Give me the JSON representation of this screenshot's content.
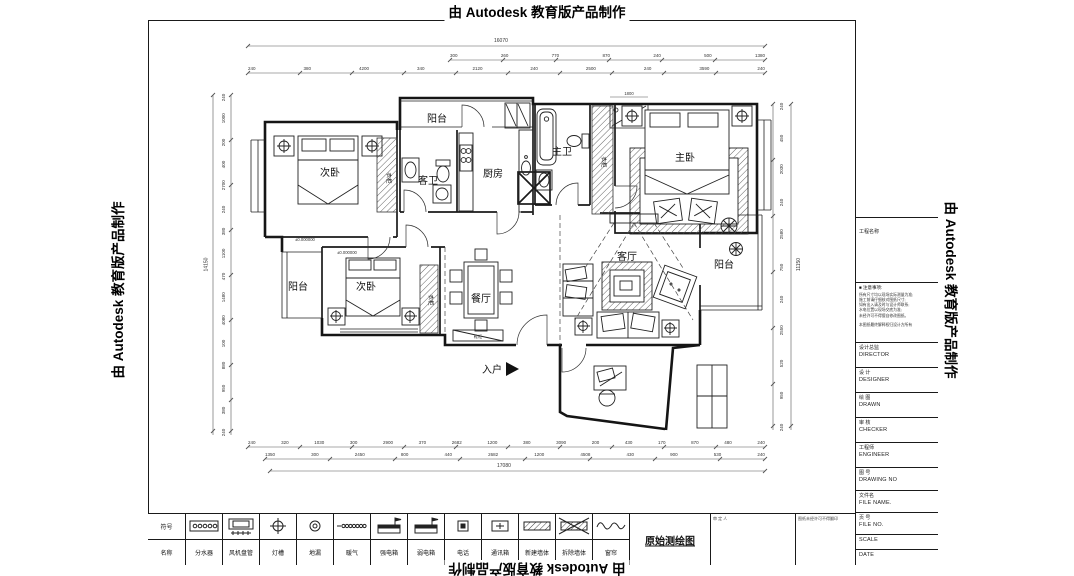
{
  "stamps": {
    "text": "由 Autodesk 教育版产品制作"
  },
  "plan": {
    "rooms": {
      "balcony_top": "阳台",
      "bedroom_top": "次卧",
      "guest_bath": "客卫",
      "kitchen": "厨房",
      "master_bath": "主卫",
      "master_bedroom": "主卧",
      "living": "客厅",
      "balcony_right": "阳台",
      "dining": "餐厅",
      "bedroom_bottom": "次卧",
      "balcony_left": "阳台",
      "entry": "入户",
      "wardrobe": "衣柜",
      "shoe_cabinet": "鞋柜"
    },
    "annotations": {
      "shower_width": "1800",
      "elevation1": "±0.000000",
      "elevation2": "±0.000000"
    }
  },
  "dims": {
    "top_overall": "16070",
    "top_row2": [
      "300",
      "260",
      "770",
      "870",
      "240",
      "500",
      "1380"
    ],
    "top_row3": [
      "240",
      "380",
      "4200",
      "340",
      "2120",
      "240",
      "2500",
      "240",
      "3590",
      "240"
    ],
    "bottom_row1": [
      "240",
      "320",
      "1030",
      "300",
      "2900",
      "370",
      "2682",
      "1200",
      "380",
      "3090",
      "200",
      "430",
      "170",
      "870",
      "480",
      "240"
    ],
    "bottom_row2": [
      "1350",
      "300",
      "2450",
      "800",
      "440",
      "2682",
      "1200",
      "4508",
      "430",
      "900",
      "530",
      "240"
    ],
    "bottom_overall": "17080",
    "left_col": [
      "240",
      "1000",
      "200",
      "400",
      "2700",
      "240",
      "380",
      "1100",
      "470",
      "1480",
      "4080",
      "100",
      "880",
      "950",
      "380",
      "240"
    ],
    "left_overall": "14150",
    "right_col": [
      "240",
      "450",
      "2030",
      "240",
      "2580",
      "750",
      "240",
      "2550",
      "520",
      "950",
      "240"
    ],
    "right_overall": "11150"
  },
  "legend": {
    "header_top": "符号",
    "header_bottom": "名称",
    "items": [
      {
        "name": "分水器",
        "icon": "manifold-icon"
      },
      {
        "name": "风机盘管",
        "icon": "fan-coil-icon"
      },
      {
        "name": "灯槽",
        "icon": "lamp-trough-icon"
      },
      {
        "name": "地漏",
        "icon": "floor-drain-icon"
      },
      {
        "name": "暖气",
        "icon": "radiator-icon"
      },
      {
        "name": "强电箱",
        "icon": "power-box-icon"
      },
      {
        "name": "弱电箱",
        "icon": "weak-current-box-icon"
      },
      {
        "name": "电话",
        "icon": "phone-icon"
      },
      {
        "name": "通讯箱",
        "icon": "comm-box-icon"
      },
      {
        "name": "新建墙体",
        "icon": "new-wall-icon"
      },
      {
        "name": "拆除墙体",
        "icon": "demolish-wall-icon"
      },
      {
        "name": "窗帘",
        "icon": "curtain-icon"
      }
    ]
  },
  "footer": {
    "title": "原始测绘图",
    "approver_label": "审 定 人",
    "note": "图纸未经许可不得翻印"
  },
  "titleblock": {
    "project_label": "工程名称",
    "notes_header": "■ 注意事项:",
    "notes": [
      "所有尺寸均以现场实际测量为准;",
      "施工前请仔细核对图纸尺寸;",
      "如有出入请及时与设计师联系;",
      "水电位置以现场交底为准;",
      "未经许可不得擅自修改图纸。"
    ],
    "notes_footer": "本图纸最终解释权归设计方所有",
    "rows": [
      {
        "cn": "设计总监",
        "en": "DIRECTOR"
      },
      {
        "cn": "设 计",
        "en": "DESIGNER"
      },
      {
        "cn": "绘 图",
        "en": "DRAWN"
      },
      {
        "cn": "审 核",
        "en": "CHECKER"
      },
      {
        "cn": "工程师",
        "en": "ENGINEER"
      },
      {
        "cn": "图 号",
        "en": "DRAWING NO"
      },
      {
        "cn": "文件名",
        "en": "FILE NAME."
      },
      {
        "cn": "页 号",
        "en": "FILE NO."
      },
      {
        "cn": "比 例",
        "en": "SCALE"
      },
      {
        "cn": "日 期",
        "en": "DATE"
      }
    ]
  }
}
